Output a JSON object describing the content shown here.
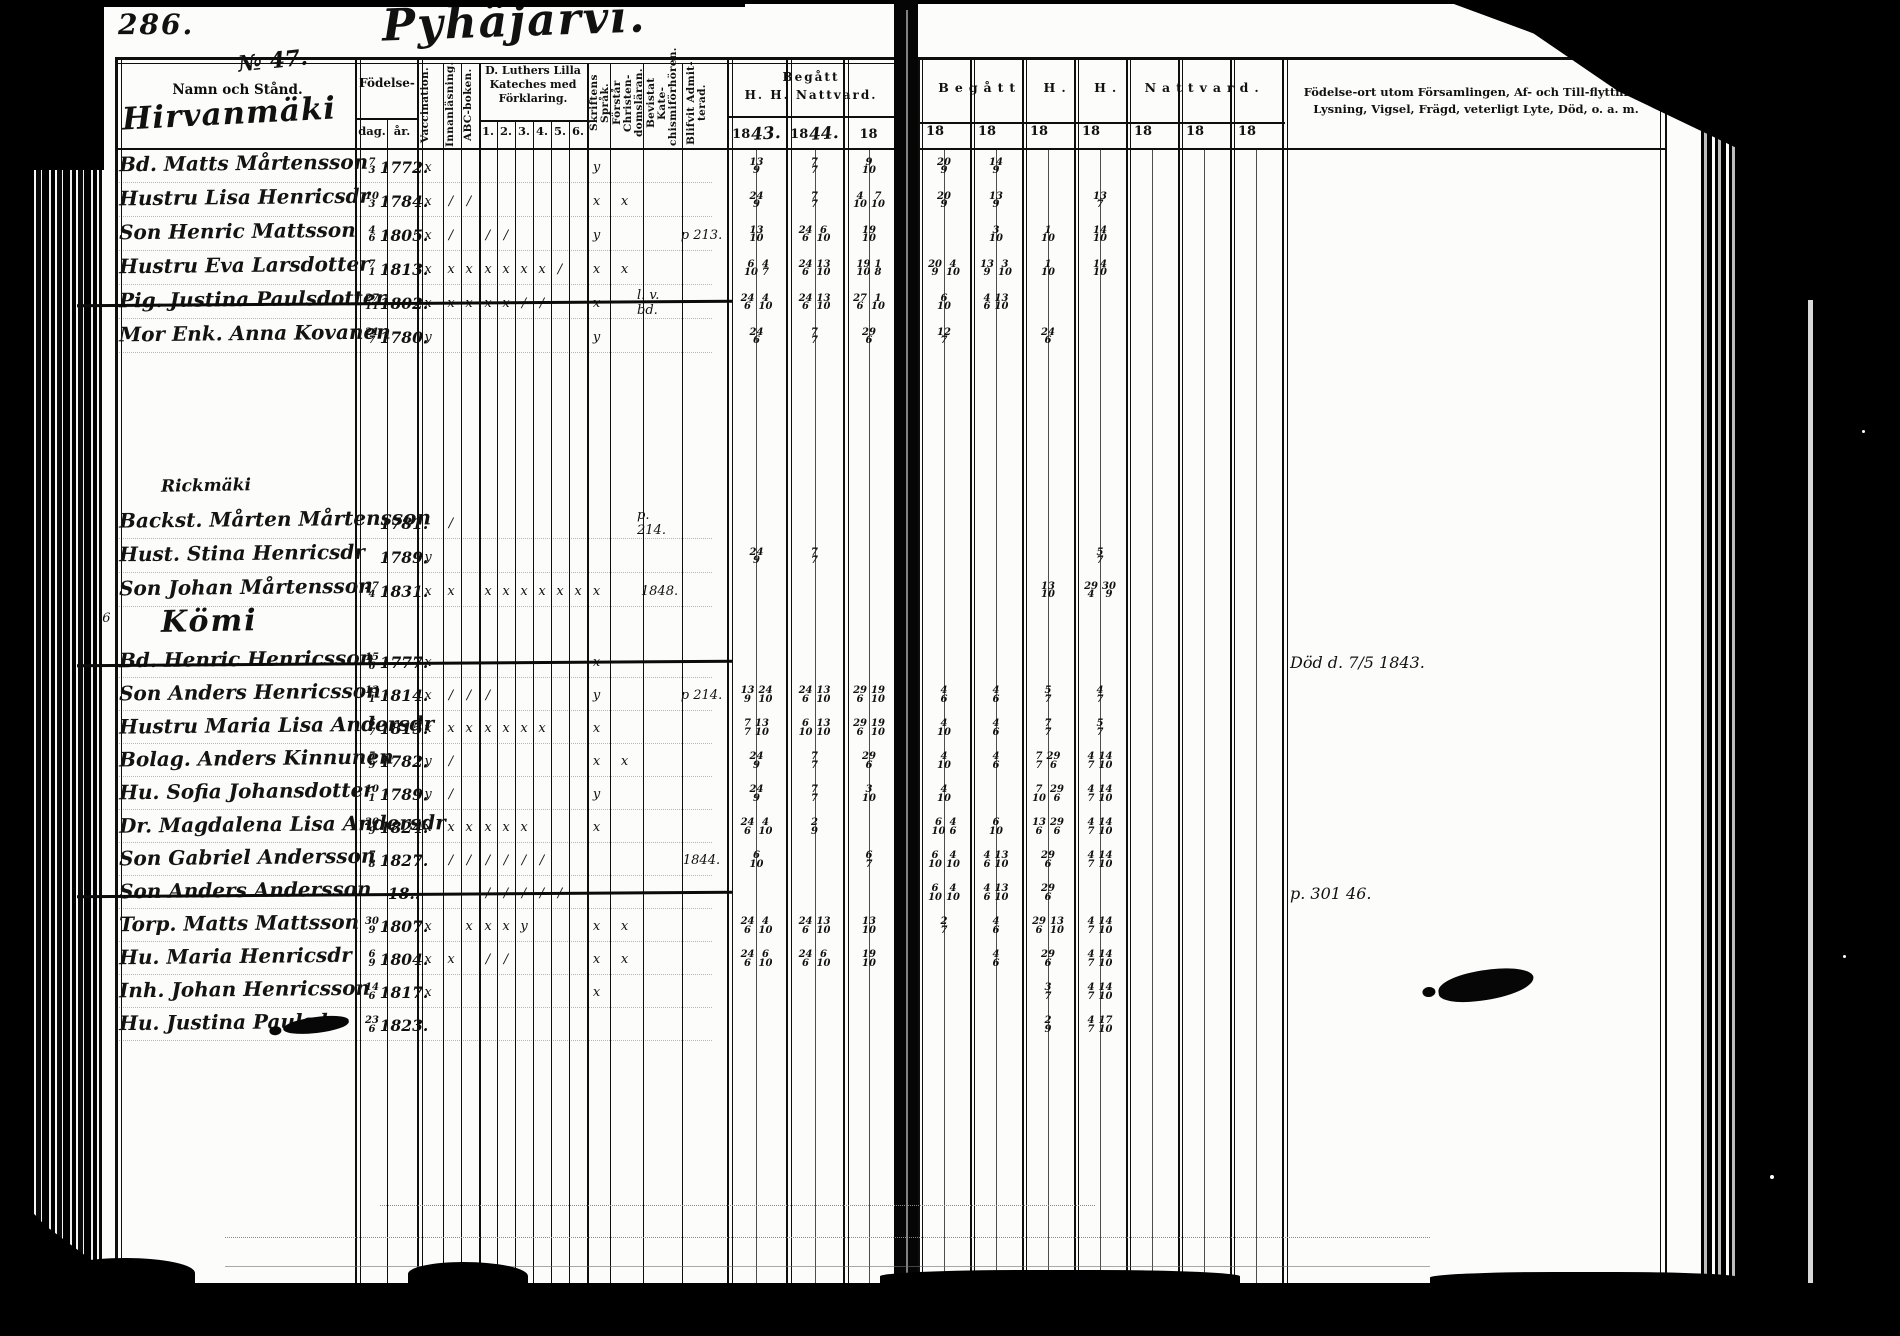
{
  "document": {
    "page_number": "286.",
    "title_script": "Pyhäjärvi.",
    "left_header": {
      "no": "№ 47.",
      "namn": "Namn och Stånd.",
      "village": "Hirvanmäki"
    },
    "birth": {
      "label": "Födelse-",
      "day": "dag.",
      "year": "år."
    },
    "vertical_columns": [
      "Vaccination.",
      "Innanläsning.",
      "ABC-boken."
    ],
    "catechism": {
      "title": "D. Luthers Lilla Kateches med Förklaring.",
      "cols": [
        "1.",
        "2.",
        "3.",
        "4.",
        "5.",
        "6."
      ]
    },
    "vertical_columns2": [
      "Skriftens Språk.",
      "Förstår Christen- domsläran.",
      "Bevistat Kate- chismiförhören.",
      "Blifvit Admit- terad."
    ],
    "communion_left": {
      "title1": "Begått",
      "title2": "H. H. Nattvard.",
      "cols": [
        {
          "printed": "18",
          "hand": "43."
        },
        {
          "printed": "18",
          "hand": "44."
        },
        {
          "printed": "18",
          "hand": ""
        }
      ]
    },
    "communion_right": {
      "title": "Begått H. H. Nattvard.",
      "cols": [
        "18",
        "18",
        "18",
        "18",
        "18",
        "18",
        "18"
      ]
    },
    "remarks_header": "Födelse-ort utom Församlingen, Af- och Till-flyttning, Lysning, Vigsel, Frägd, veterligt Lyte, Död, o. a. m.",
    "margin_mark": "3."
  },
  "rows": [
    {
      "t": "e",
      "name": "Bd. Matts Mårtensson",
      "dag": "7/3",
      "ar": "1772.",
      "vacc": "x",
      "sprak": "y",
      "n43": "13/9",
      "n44": "7/7",
      "n18": "9/10",
      "right": [
        "20/9",
        "14/9",
        "",
        "",
        "",
        "",
        ""
      ]
    },
    {
      "t": "e",
      "name": "Hustru Lisa Henricsdr",
      "dag": "10/3",
      "ar": "1784.",
      "vacc": "x",
      "inn": "/",
      "abc": "/",
      "sprak": "x",
      "forst": "x",
      "n43": "24/9",
      "n44": "7/7",
      "n18": "4/10 7/10",
      "right": [
        "20/9",
        "13/9",
        "",
        "13/7",
        "",
        "",
        ""
      ]
    },
    {
      "t": "e",
      "name": "Son Henric Mattsson",
      "dag": "4/6",
      "ar": "1805.",
      "vacc": "x",
      "inn": "/",
      "kat": [
        "/",
        "/",
        "",
        "",
        "",
        ""
      ],
      "sprak": "y",
      "adm": "p 213.",
      "n43": "13/10",
      "n44": "24/6 6/10",
      "n18": "19/10",
      "right": [
        "",
        "3/10",
        "1/10",
        "14/10",
        "",
        "",
        ""
      ]
    },
    {
      "t": "e",
      "name": "Hustru Eva Larsdotter",
      "dag": "7/1",
      "ar": "1813.",
      "vacc": "x",
      "inn": "x",
      "abc": "x",
      "kat": [
        "x",
        "x",
        "x",
        "x",
        "/",
        ""
      ],
      "sprak": "x",
      "forst": "x",
      "n43": "6/10 4/7",
      "n44": "24/6 13/10",
      "n18": "19/10 1/8",
      "right": [
        "20/9 4/10",
        "13/9 3/10",
        "1/10",
        "14/10",
        "",
        "",
        ""
      ]
    },
    {
      "t": "e",
      "name": "Pig. Justina Paulsdotter",
      "dag": "27/11",
      "ar": "1802.",
      "strike": true,
      "vacc": "x",
      "inn": "x",
      "abc": "x",
      "kat": [
        "x",
        "x",
        "/",
        "/",
        "",
        ""
      ],
      "sprak": "x",
      "bev": "l. v. bd.",
      "n43": "24/6 4/10",
      "n44": "24/6 13/10",
      "n18": "27/6 1/10",
      "right": [
        "6/10",
        "4/6 13/10",
        "",
        "",
        "",
        "",
        ""
      ]
    },
    {
      "t": "e",
      "name": "Mor Enk. Anna Kovanen",
      "dag": "21/7",
      "ar": "1780.",
      "vacc": "y",
      "sprak": "y",
      "n43": "24/6",
      "n44": "7/7",
      "n18": "29/6",
      "right": [
        "12/7",
        "",
        "24/6",
        "",
        "",
        "",
        ""
      ]
    },
    {
      "t": "sp"
    },
    {
      "t": "s",
      "label": "Rickmäki",
      "style": "small"
    },
    {
      "t": "e",
      "name": "Backst. Mårten Mårtensson",
      "ar": "1781.",
      "inn": "/",
      "bev": "p. 214."
    },
    {
      "t": "e",
      "name": "Hust. Stina Henricsdr",
      "ar": "1789.",
      "vacc": "y",
      "n43": "24/9",
      "n44": "7/7",
      "right": [
        "",
        "",
        "",
        "5/7",
        "",
        "",
        ""
      ]
    },
    {
      "t": "e",
      "name": "Son Johan Mårtensson",
      "dag": "27/4",
      "ar": "1831.",
      "vacc": "x",
      "inn": "x",
      "kat": [
        "x",
        "x",
        "x",
        "x",
        "x",
        "x"
      ],
      "sprak": "x",
      "bev": "1848.",
      "right": [
        "",
        "",
        "13/10",
        "29/4 30/9",
        "",
        "",
        ""
      ]
    },
    {
      "t": "s",
      "label": "Kömi",
      "style": "large",
      "margin": "14/7 36"
    },
    {
      "t": "e",
      "name": "Bd. Henric Henricsson",
      "dag": "15/6",
      "ar": "1777.",
      "strike": true,
      "vacc": "x",
      "sprak": "x",
      "note": "Död d. 7/5 1843."
    },
    {
      "t": "e",
      "name": "Son Anders Henricsson",
      "dag": "13/1",
      "ar": "1814.",
      "vacc": "x",
      "inn": "/",
      "abc": "/",
      "kat": [
        "/",
        "",
        "",
        "",
        "",
        ""
      ],
      "sprak": "y",
      "adm": "p 214.",
      "n43": "13/9 24/10",
      "n44": "24/6 13/10",
      "n18": "29/6 19/10",
      "right": [
        "4/6",
        "4/6",
        "5/7",
        "4/7",
        "",
        "",
        ""
      ]
    },
    {
      "t": "e",
      "name": "Hustru Maria Lisa Andersdr",
      "dag": "6/7",
      "ar": "1815.",
      "vacc": "x",
      "inn": "x",
      "abc": "x",
      "kat": [
        "x",
        "x",
        "x",
        "x",
        "",
        ""
      ],
      "sprak": "x",
      "n43": "7/7 13/10",
      "n44": "6/10 13/10",
      "n18": "29/6 19/10",
      "right": [
        "4/10",
        "4/6",
        "7/7",
        "5/7",
        "",
        "",
        ""
      ]
    },
    {
      "t": "e",
      "name": "Bolag. Anders Kinnunen",
      "dag": "5/9",
      "ar": "1782.",
      "vacc": "y",
      "inn": "/",
      "sprak": "x",
      "forst": "x",
      "n43": "24/9",
      "n44": "7/7",
      "n18": "29/6",
      "right": [
        "4/10",
        "4/6",
        "7/7 29/6",
        "4/7 14/10",
        "",
        "",
        ""
      ]
    },
    {
      "t": "e",
      "name": "Hu. Sofia Johansdotter",
      "dag": "10/1",
      "ar": "1789.",
      "vacc": "y",
      "inn": "/",
      "sprak": "y",
      "n43": "24/9",
      "n44": "7/7",
      "n18": "3/10",
      "right": [
        "4/10",
        "",
        "7/10 29/6",
        "4/7 14/10",
        "",
        "",
        ""
      ]
    },
    {
      "t": "e",
      "name": "Dr. Magdalena Lisa Andersdr",
      "dag": "20/9",
      "ar": "1824.",
      "vacc": "x",
      "inn": "x",
      "abc": "x",
      "kat": [
        "x",
        "x",
        "x",
        "",
        "",
        ""
      ],
      "sprak": "x",
      "n43": "24/6 4/10",
      "n44": "2/9",
      "right": [
        "6/10 4/6",
        "6/10",
        "13/6 29/6",
        "4/7 14/10",
        "",
        "",
        ""
      ]
    },
    {
      "t": "e",
      "name": "Son Gabriel Andersson",
      "dag": "7/8",
      "ar": "1827.",
      "inn": "/",
      "abc": "/",
      "kat": [
        "/",
        "/",
        "/",
        "/",
        "",
        ""
      ],
      "adm": "1844.",
      "n43": "6/10",
      "n18": "6/7",
      "right": [
        "6/10 4/10",
        "4/6 13/10",
        "29/6",
        "4/7 14/10",
        "",
        "",
        ""
      ]
    },
    {
      "t": "e",
      "name": "Son Anders Andersson",
      "ar": "18..",
      "strike": true,
      "kat": [
        "/",
        "/",
        "/",
        "/",
        "/",
        ""
      ],
      "note": "p. 301 46.",
      "right": [
        "6/10 4/10",
        "4/6 13/10",
        "29/6",
        "",
        "",
        "",
        ""
      ]
    },
    {
      "t": "e",
      "name": "Torp. Matts Mattsson",
      "dag": "30/9",
      "ar": "1807.",
      "vacc": "x",
      "abc": "x",
      "kat": [
        "x",
        "x",
        "y",
        "",
        "",
        ""
      ],
      "sprak": "x",
      "forst": "x",
      "n43": "24/6 4/10",
      "n44": "24/6 13/10",
      "n18": "13/10",
      "right": [
        "2/7",
        "4/6",
        "29/6 13/10",
        "4/7 14/10",
        "",
        "",
        ""
      ]
    },
    {
      "t": "e",
      "name": "Hu. Maria Henricsdr",
      "dag": "6/9",
      "ar": "1804.",
      "vacc": "x",
      "inn": "x",
      "kat": [
        "/",
        "/",
        "",
        "",
        "",
        ""
      ],
      "sprak": "x",
      "forst": "x",
      "n43": "24/6 6/10",
      "n44": "24/6 6/10",
      "n18": "19/10",
      "right": [
        "",
        "4/6",
        "29/6",
        "4/7 14/10",
        "",
        "",
        ""
      ]
    },
    {
      "t": "e",
      "name": "Inh. Johan Henricsson",
      "dag": "14/6",
      "ar": "1817.",
      "vacc": "x",
      "sprak": "x",
      "right": [
        "",
        "",
        "3/7",
        "4/7 14/10",
        "",
        "",
        ""
      ]
    },
    {
      "t": "e",
      "name": "Hu. Justina Paulsdr",
      "dag": "23/6",
      "ar": "1823.",
      "blob": true,
      "right": [
        "",
        "",
        "2/9",
        "4/7 17/10",
        "",
        "",
        ""
      ]
    }
  ]
}
